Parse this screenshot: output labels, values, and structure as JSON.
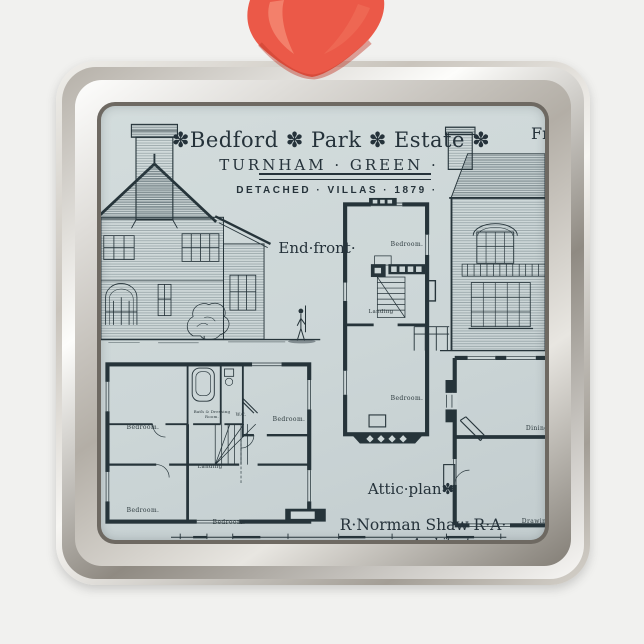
{
  "colors": {
    "background": "#f1f1ef",
    "print_background": "#ccd6d7",
    "ink": "#26343a",
    "ribbon_red": "#eb5948",
    "frame_silver": "#c9c4bc"
  },
  "print": {
    "title": "✽Bedford ✽ Park ✽ Estate ✽",
    "subtitle": "TURNHAM · GREEN ·",
    "caption": "DETACHED · VILLAS ·  1879 ·",
    "front_label": "Front",
    "end_front_label": "End·front·",
    "attic_caption": "Attic·plan✽",
    "architect_name": "R·Norman Shaw R·A·",
    "architect_title": "Architect.",
    "scale_label": "Scale·of·feet",
    "scale_numbers": [
      "10",
      "5",
      "0",
      "10",
      "20",
      "30",
      "40"
    ],
    "attic_rooms": {
      "bedroom_top": "Bedroom.",
      "landing": "Landing",
      "bedroom_bottom": "Bedroom."
    },
    "first_floor_rooms": {
      "bedroom_top_left": "Bedroom.",
      "bath_line1": "Bath & Dressing",
      "bath_line2": "Room.",
      "wc": "W.C.",
      "bedroom_top_right": "Bedroom.",
      "landing": "Landing",
      "bedroom_bottom_left": "Bedroom.",
      "bedroom_bottom_mid": "Bedroom."
    },
    "ground_floor_rooms": {
      "dining": "Dining Room.",
      "drawing": "Drawing Room."
    }
  }
}
